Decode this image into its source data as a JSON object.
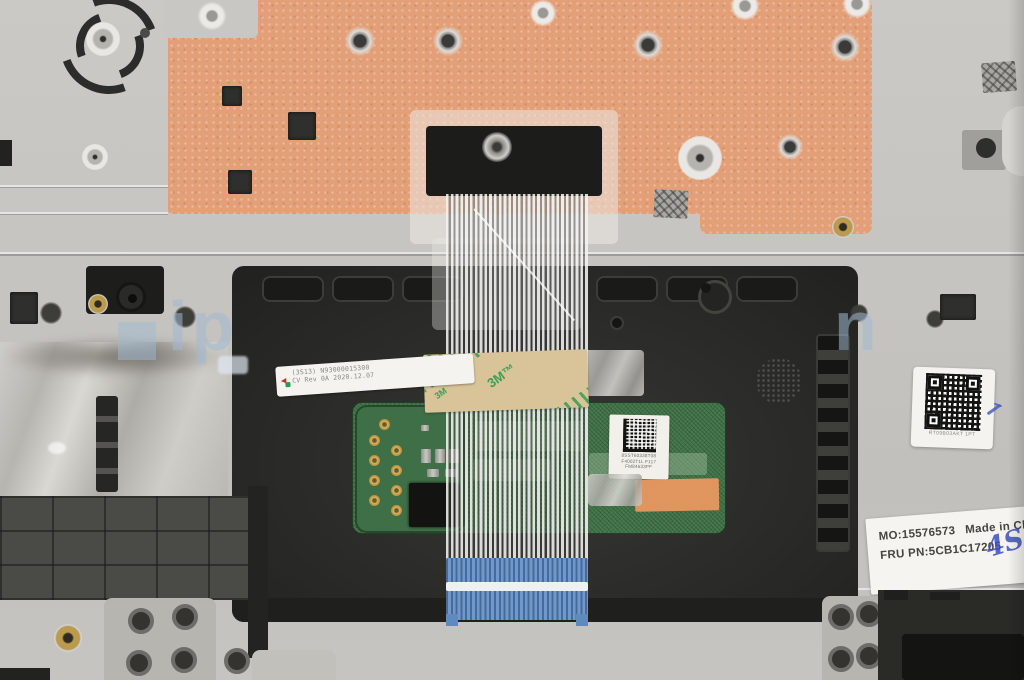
{
  "watermark": {
    "text_left": "ip",
    "text_right": "n"
  },
  "fru_label": {
    "mo": "MO:15576573",
    "made_in": "Made in Ch",
    "fru": "FRU PN:5CB1C17205",
    "handwriting": "4S"
  },
  "cable_label": {
    "line1": "(3S13) N93000015300",
    "line2": "CV Rev 0A 2020.12.07",
    "mark": "◄"
  },
  "pcb_label": {
    "line1": "8SST60338T08",
    "line2": "F4002T1L F117",
    "line3": "FM84633PF"
  },
  "qr_label": {
    "caption": "RT09B03AKT 1PT"
  },
  "tape": {
    "brand_mark": "3M™",
    "brand_mark_small": "3M"
  },
  "colors": {
    "palmrest_metal": "#c7c5c1",
    "mylar_orange": "#e3a078",
    "touchpad_frame_black": "#2c2c2a",
    "pcb_green": "#477a4e",
    "tape_tan": "#d9c399",
    "tape_print_green": "#2a9a4f",
    "connector_blue": "#6f99cc",
    "foil_silver": "#bab7b2",
    "label_white": "#f6f4f0",
    "pen_blue": "#3d4fc3"
  }
}
